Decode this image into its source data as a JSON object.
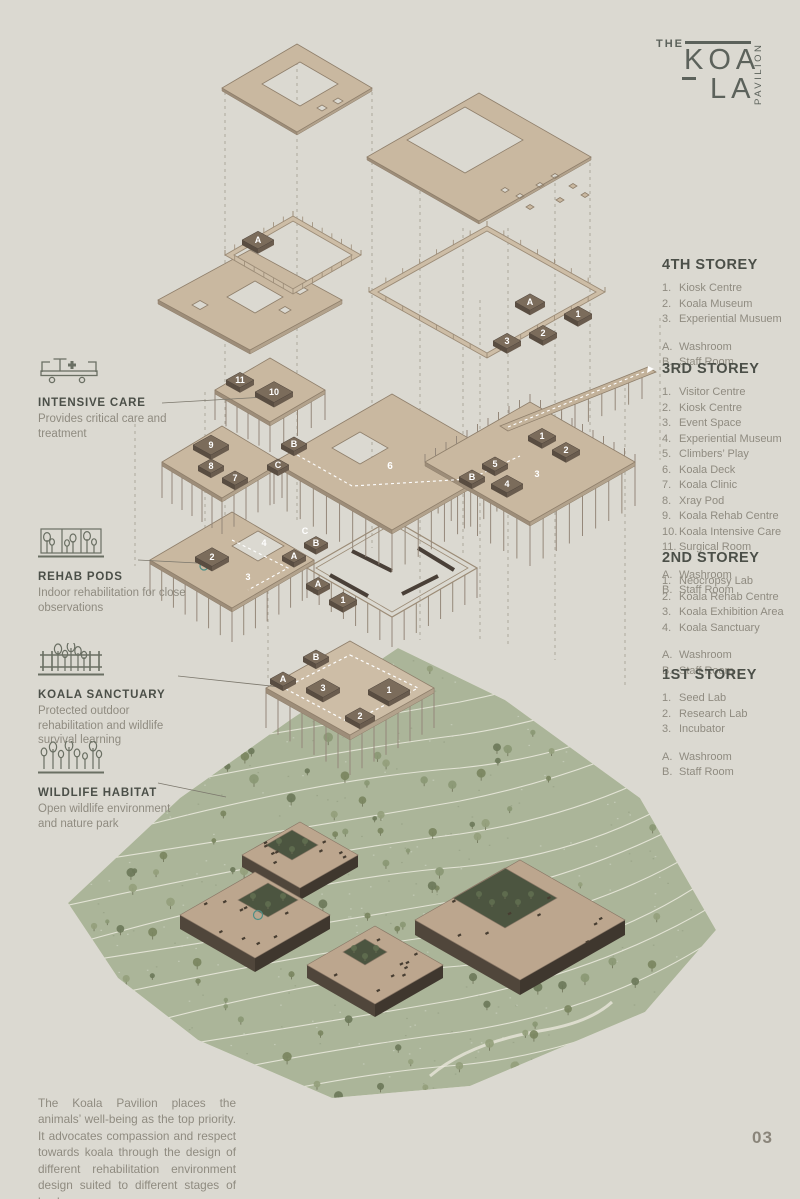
{
  "logo": {
    "the": "THE",
    "koa": "KOA",
    "la": "LA",
    "pavilion": "PAVILION"
  },
  "legend": {
    "storeys": [
      {
        "title": "4TH STOREY",
        "rooms": [
          {
            "n": "1.",
            "label": "Kiosk Centre"
          },
          {
            "n": "2.",
            "label": "Koala Museum"
          },
          {
            "n": "3.",
            "label": "Experiential Musuem"
          }
        ],
        "facilities": [
          {
            "n": "A.",
            "label": "Washroom"
          },
          {
            "n": "B.",
            "label": "Staff Room"
          }
        ]
      },
      {
        "title": "3RD STOREY",
        "rooms": [
          {
            "n": "1.",
            "label": "Visitor Centre"
          },
          {
            "n": "2.",
            "label": "Kiosk Centre"
          },
          {
            "n": "3.",
            "label": "Event Space"
          },
          {
            "n": "4.",
            "label": "Experiential Museum"
          },
          {
            "n": "5.",
            "label": "Climbers’ Play"
          },
          {
            "n": "6.",
            "label": "Koala Deck"
          },
          {
            "n": "7.",
            "label": "Koala Clinic"
          },
          {
            "n": "8.",
            "label": "Xray Pod"
          },
          {
            "n": "9.",
            "label": "Koala Rehab Centre"
          },
          {
            "n": "10.",
            "label": "Koala Intensive Care"
          },
          {
            "n": "11.",
            "label": "Surgical Room"
          }
        ],
        "facilities": [
          {
            "n": "A.",
            "label": "Washroom"
          },
          {
            "n": "B.",
            "label": "Staff Room"
          }
        ]
      },
      {
        "title": "2ND STOREY",
        "rooms": [
          {
            "n": "1.",
            "label": "Neocropsy Lab"
          },
          {
            "n": "2.",
            "label": "Koala Rehab Centre"
          },
          {
            "n": "3.",
            "label": "Koala Exhibition Area"
          },
          {
            "n": "4.",
            "label": "Koala Sanctuary"
          }
        ],
        "facilities": [
          {
            "n": "A.",
            "label": "Washroom"
          },
          {
            "n": "B.",
            "label": "Staff Room"
          }
        ]
      },
      {
        "title": "1ST STOREY",
        "rooms": [
          {
            "n": "1.",
            "label": "Seed Lab"
          },
          {
            "n": "2.",
            "label": "Research Lab"
          },
          {
            "n": "3.",
            "label": "Incubator"
          }
        ],
        "facilities": [
          {
            "n": "A.",
            "label": "Washroom"
          },
          {
            "n": "B.",
            "label": "Staff Room"
          }
        ]
      }
    ]
  },
  "annotations": [
    {
      "title": "INTENSIVE CARE",
      "desc": "Provides critical care and treatment",
      "icon": "stretcher-icon"
    },
    {
      "title": "REHAB PODS",
      "desc": "Indoor rehabilitation for close observations",
      "icon": "indoor-trees-icon"
    },
    {
      "title": "KOALA SANCTUARY",
      "desc": "Protected outdoor rehabilitation and wildlife survival learning",
      "icon": "fenced-trees-icon"
    },
    {
      "title": "WILDLIFE HABITAT",
      "desc": "Open wildlife environment and nature park",
      "icon": "trees-icon"
    }
  ],
  "footer": {
    "paragraph": "The Koala Pavilion places the animals’ well-being as the top priority. It advocates compassion and respect towards koala through the design of different rehabilitation environment design suited to different stages of koala care.",
    "page_number": "03"
  },
  "diagram": {
    "colors": {
      "background": "#dbd9d1",
      "plate_tan": "#c9b8a0",
      "plate_edge": "#8f7f6b",
      "dark_room": "#7b6c5b",
      "terrain_green": "#abb599",
      "accent_teal": "#4f8f86",
      "column": "#95887a"
    },
    "markers": [
      {
        "label": "A",
        "x": 258,
        "y": 240,
        "w": 16
      },
      {
        "label": "A",
        "x": 530,
        "y": 302,
        "w": 15
      },
      {
        "label": "1",
        "x": 578,
        "y": 314,
        "w": 14
      },
      {
        "label": "2",
        "x": 543,
        "y": 333,
        "w": 14
      },
      {
        "label": "3",
        "x": 507,
        "y": 341,
        "w": 14
      },
      {
        "label": "11",
        "x": 240,
        "y": 380,
        "w": 14
      },
      {
        "label": "10",
        "x": 274,
        "y": 392,
        "w": 19
      },
      {
        "label": "9",
        "x": 211,
        "y": 445,
        "w": 18
      },
      {
        "label": "8",
        "x": 211,
        "y": 466,
        "w": 13
      },
      {
        "label": "7",
        "x": 235,
        "y": 478,
        "w": 13
      },
      {
        "label": "B",
        "x": 294,
        "y": 444,
        "w": 13
      },
      {
        "label": "C",
        "x": 278,
        "y": 465,
        "w": 11
      },
      {
        "label": "6",
        "x": 390,
        "y": 466,
        "w": 0
      },
      {
        "label": "B",
        "x": 472,
        "y": 477,
        "w": 13
      },
      {
        "label": "5",
        "x": 495,
        "y": 464,
        "w": 13
      },
      {
        "label": "4",
        "x": 507,
        "y": 484,
        "w": 16
      },
      {
        "label": "3",
        "x": 537,
        "y": 474,
        "w": 0
      },
      {
        "label": "2",
        "x": 566,
        "y": 450,
        "w": 14
      },
      {
        "label": "1",
        "x": 542,
        "y": 436,
        "w": 14
      },
      {
        "label": "2",
        "x": 212,
        "y": 557,
        "w": 17
      },
      {
        "label": "3",
        "x": 248,
        "y": 577,
        "w": 0
      },
      {
        "label": "4",
        "x": 264,
        "y": 543,
        "w": 0
      },
      {
        "label": "A",
        "x": 294,
        "y": 556,
        "w": 12
      },
      {
        "label": "B",
        "x": 316,
        "y": 543,
        "w": 12
      },
      {
        "label": "C",
        "x": 305,
        "y": 531,
        "w": 0
      },
      {
        "label": "A",
        "x": 318,
        "y": 584,
        "w": 12
      },
      {
        "label": "1",
        "x": 343,
        "y": 600,
        "w": 14
      },
      {
        "label": "B",
        "x": 316,
        "y": 657,
        "w": 13
      },
      {
        "label": "A",
        "x": 283,
        "y": 679,
        "w": 13
      },
      {
        "label": "3",
        "x": 323,
        "y": 688,
        "w": 17
      },
      {
        "label": "1",
        "x": 389,
        "y": 690,
        "w": 21
      },
      {
        "label": "2",
        "x": 360,
        "y": 716,
        "w": 15
      }
    ]
  }
}
